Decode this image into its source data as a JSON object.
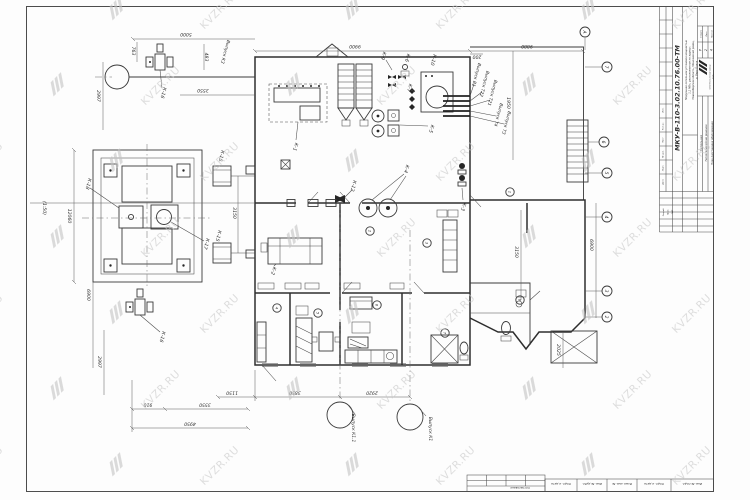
{
  "watermark": {
    "text": "KVZR.RU"
  },
  "sheet": {
    "scale_note": "(1:50)",
    "stamp": {
      "doc_number": "МКУ-В-110-3.02.10.76.00-ТМ",
      "object_lines": [
        "Модульная котельная установка мощностью",
        "1,1 МВт, расположенная по адресу:",
        "Новосибирская область, Мошковский район,",
        "д. Верх-Балта"
      ],
      "section": "Котельная",
      "discipline": "Теплотехнические решения",
      "sheet_name": "План расстановки оборудования",
      "stage_header": "Стадия",
      "sheet_header": "Лист",
      "sheets_header": "Листов",
      "stage": "Р",
      "sheet_no": "2",
      "sheets_total": "4",
      "company_line1": "ООО Котельный завод",
      "company_line2": "«РЭП»",
      "sig_labels": [
        "Разраб.",
        "Пров.",
        "ГИП"
      ],
      "rev_labels": [
        "Изм.",
        "Кол.уч.",
        "Лист",
        "№ док.",
        "Подп.",
        "Дата"
      ],
      "agreed": "Согласовано",
      "side_cells": [
        "Подп. и дата",
        "Инв. № дубл.",
        "Взам. инв. №",
        "Подп. и дата",
        "Инв. № подл."
      ]
    },
    "dims": {
      "d5000": "5000",
      "d763": "763",
      "d483": "483",
      "d3550a": "3550",
      "d2997a": "2997",
      "d9900": "9900",
      "d9880": "9880",
      "d200": "200",
      "d1950": "1950",
      "d3150a": "3150",
      "d3150b": "3150",
      "d12060": "12060",
      "d6900a": "6900",
      "d6900b": "6900",
      "d2997b": "2997",
      "d910": "910",
      "d3550b": "3550",
      "d4950": "4950",
      "d1150": "1150",
      "d3850": "3850",
      "d2920": "2920",
      "d2025": "2025"
    },
    "equipment": {
      "k1": "К-1",
      "k2": "К-2",
      "k3": "К-3",
      "k4": "К-4",
      "k5": "К-5",
      "k6": "К-6",
      "k7": "К-7",
      "k9": "К-9",
      "k10": "К-10",
      "k12": "К-12",
      "k15": "К-15",
      "k16": "К-16",
      "k17": "К-17",
      "k18": "К-18"
    },
    "outlets": {
      "k3": "Выпуск К3",
      "v1": "Выпуск В1",
      "t22": "Выпуск Т22",
      "t21": "Выпуск Т21",
      "t4": "Выпуск Т4",
      "t3": "Выпуск Т3",
      "k11": "Выпуск К1.1",
      "k1": "Выпуск К1"
    },
    "axes": [
      "А",
      "7",
      "6",
      "5",
      "4",
      "3",
      "2"
    ],
    "rooms": [
      "1",
      "2",
      "3",
      "4",
      "5",
      "6",
      "7",
      "8"
    ]
  }
}
